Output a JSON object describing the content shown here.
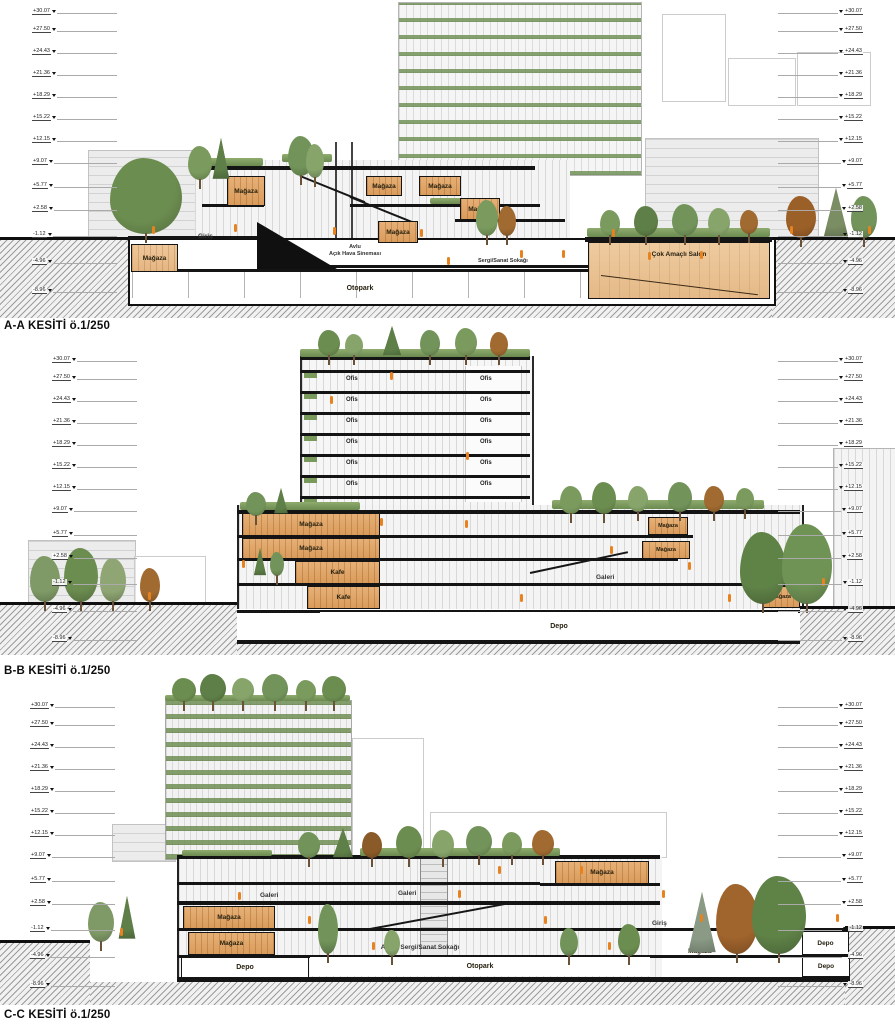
{
  "drawing": {
    "colors": {
      "wood_box": "#e0a76f",
      "salon_fill": "#ecc9a0",
      "tree_green": "#6c8d50",
      "figure_orange": "#e8821e"
    }
  },
  "elevations": {
    "values": [
      "+30.07",
      "+27.50",
      "+24.43",
      "+21.36",
      "+18.29",
      "+15.22",
      "+12.15",
      "+9.07",
      "+5.77",
      "+2.58",
      "-1.12",
      "-4.96",
      "-8.96"
    ]
  },
  "sections": {
    "aa": {
      "title": "A-A KESİTİ ö.1/250",
      "labels": {
        "magaza": "Mağaza",
        "giris": "Giriş",
        "avlu": "Avlu",
        "acik_hava_sinemasi": "Açık Hava Sineması",
        "sergi_sanat_sokagi": "Sergi/Sanat Sokağı",
        "cok_amacli_salon": "Çok Amaçlı Salon",
        "otopark": "Otopark"
      }
    },
    "bb": {
      "title": "B-B KESİTİ ö.1/250",
      "labels": {
        "ofis": "Ofis",
        "magaza": "Mağaza",
        "kafe": "Kafe",
        "galeri": "Galeri",
        "depo": "Depo"
      }
    },
    "cc": {
      "title": "C-C KESİTİ ö.1/250",
      "labels": {
        "galeri": "Galeri",
        "magaza": "Mağaza",
        "giris": "Giriş",
        "avlu_sergi_sanat_sokagi": "Avlu - Sergi/Sanat Sokağı",
        "depo": "Depo",
        "otopark": "Otopark"
      }
    }
  }
}
